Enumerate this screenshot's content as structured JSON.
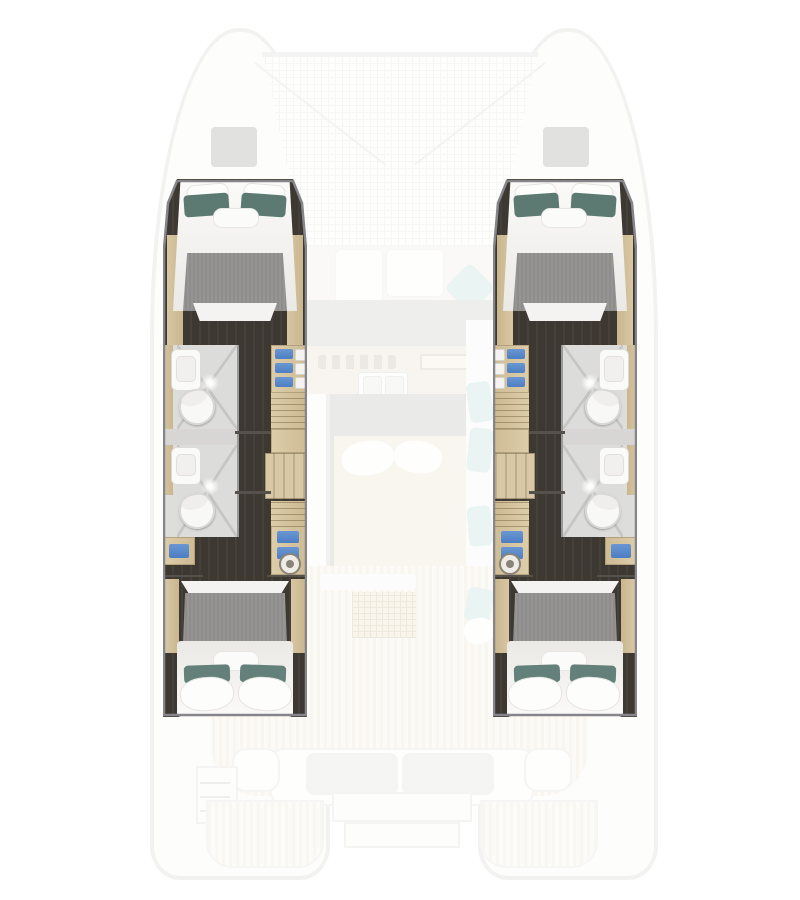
{
  "meta": {
    "content_type": "catamaran-interior-deck-plan",
    "canvas_width": 800,
    "canvas_height": 900,
    "style": "top-down rendered floor plan; central saloon and exterior decks shown ghosted, four hull cabin suites highlighted"
  },
  "palette": {
    "background": "#ffffff",
    "hull_outline_faded": "#e2e2e0",
    "trampoline_grid": "#ececea",
    "bow_hatch_gray": "#b8b8b6",
    "dark_cabin_floor": "#3e3833",
    "wood_trim": "#cfbc97",
    "cabinet_wood": "#d8c7a4",
    "bed_runner_gray": "#8e8d8b",
    "bedding_white": "#f6f5f3",
    "pillow_teal_forward": "#5c7a72",
    "pillow_teal_aft": "#64807a",
    "bathroom_floor": "#dcdcda",
    "shower_glass_line": "#c6c6c4",
    "fixture_white": "#fafaf8",
    "shelf_item_blue": "#4c7ec3",
    "suite_outline": "#85858a",
    "teak_deck": "#f1ebdc",
    "saloon_floor_gray": "#cecfcc",
    "accent_teal_ghost": "#cfe6e2"
  },
  "plan": {
    "hulls": 2,
    "highlighted_cabin_suites": 4,
    "double_beds": 4,
    "bathrooms": 4,
    "showers": 4,
    "toilets": 4,
    "wardrobes": 4,
    "stairways": 2,
    "regions": [
      "bow-trampoline",
      "bow-hatches",
      "foredeck-lounge",
      "galley",
      "saloon",
      "port-forward-cabin",
      "port-aft-cabin",
      "port-bathrooms",
      "port-corridor",
      "starboard-forward-cabin",
      "starboard-aft-cabin",
      "starboard-bathrooms",
      "starboard-corridor",
      "cockpit",
      "aft-bench",
      "swim-platforms"
    ]
  },
  "icons": {
    "sparkle-icon": "light glint on shower glass (radial white dot)",
    "washer-icon": "round appliance/porthole front in wardrobe column",
    "hatch-icon": "gray deck hatch square",
    "hanger-icon": "closet rail with hangers (fine horizontal lines)"
  }
}
